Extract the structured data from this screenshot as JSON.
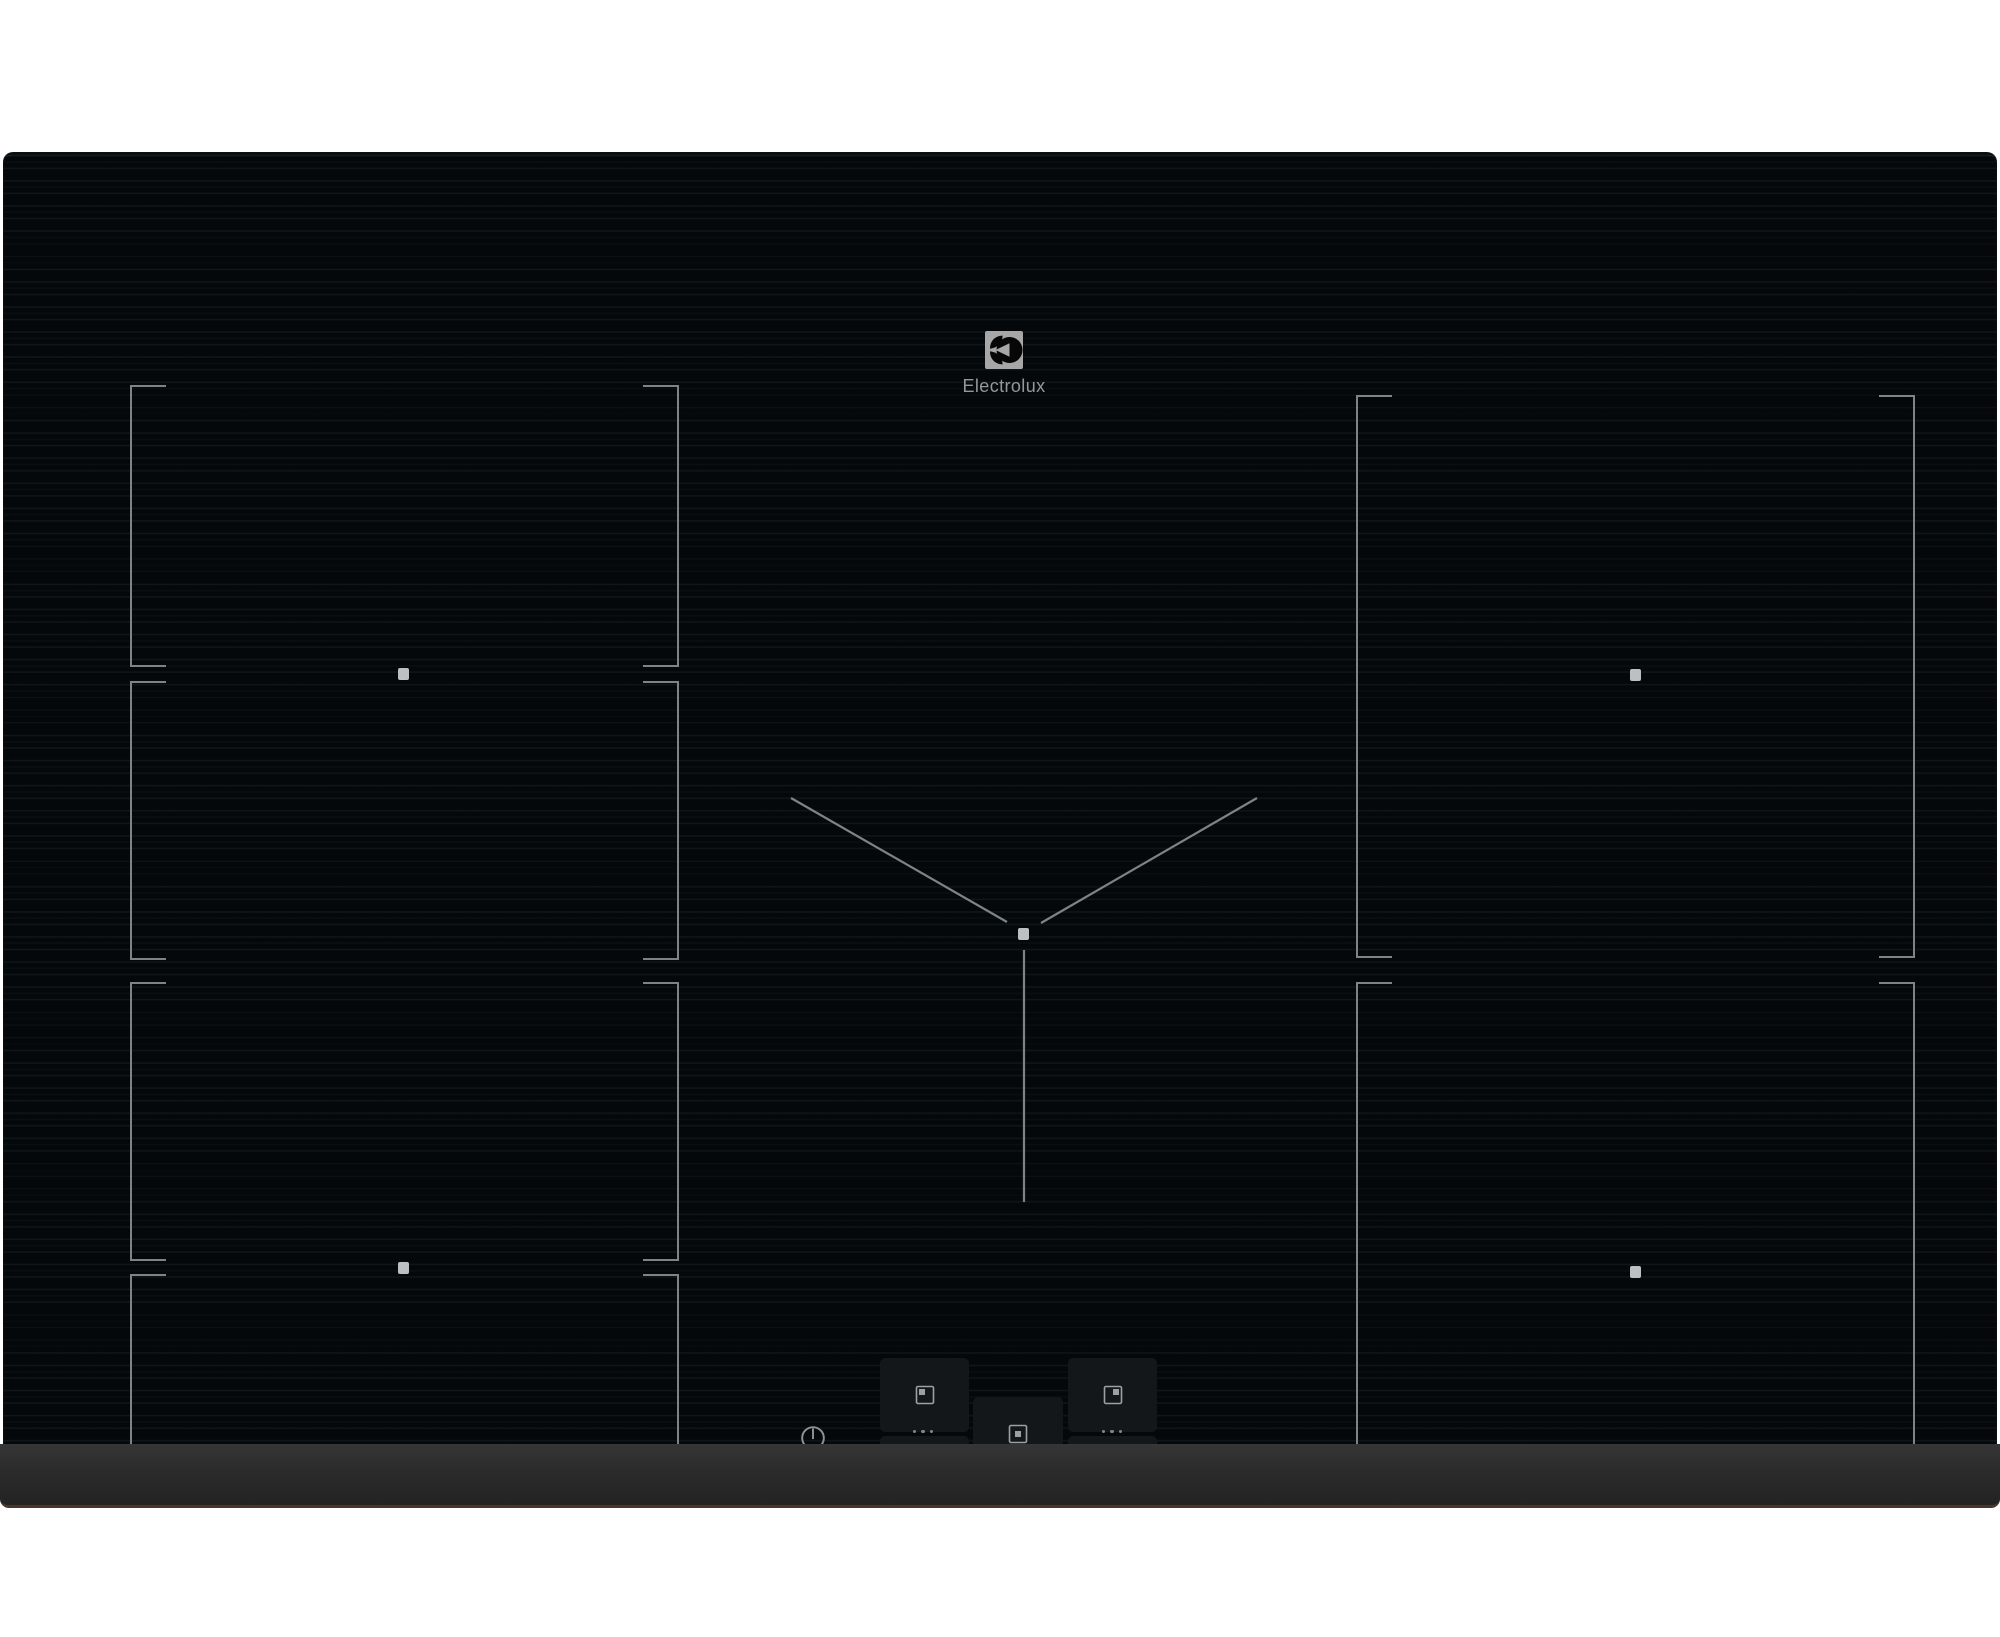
{
  "device": {
    "brand_wordmark": "Electrolux",
    "series_label": "SENSE PRO",
    "type": "induction hob, black glass, 5 flex cooking zones"
  },
  "colors": {
    "background": "#ffffff",
    "glass": "#04080a",
    "stripe": "#15202a",
    "bracket_line": "#7e8387",
    "zone_dot": "#bdc0c2",
    "pad_background": "#14171a",
    "pad_icon": "#9aa0a4",
    "secondary_icon": "#686e73",
    "power_icon": "#8d9296",
    "label_text": "#aeb2b5",
    "wordmark_text": "#95989b",
    "logo_plate": "#a7a7a7",
    "bezel": "#2b2b2b",
    "bezel_bottom_edge": "#4e332a"
  },
  "zones": {
    "left_flex_segments": [
      "rear-left-segment-1",
      "rear-left-segment-2",
      "front-left-segment-3",
      "front-left-segment-4"
    ],
    "right_zones": [
      "rear-right-zone",
      "front-right-zone"
    ],
    "center_zone": "center-sensepro-zone-with-v-marking",
    "zone_center_dots": 5
  },
  "controls": {
    "power_button": "power-standby",
    "zone_pads": [
      {
        "zone": "rear-left",
        "glyph": "square-marker-top-left"
      },
      {
        "zone": "front-left",
        "glyph": "square-marker-bottom-left"
      },
      {
        "zone": "center",
        "glyph": "square-marker-center"
      },
      {
        "zone": "rear-right",
        "glyph": "square-marker-top-right"
      },
      {
        "zone": "front-right",
        "glyph": "square-marker-bottom-right"
      }
    ],
    "more_indicator": "three-dots",
    "menu_icons": [
      "wifi",
      "pencil",
      "menu-lines",
      "bridge-squares",
      "hob2hood-fan"
    ]
  }
}
